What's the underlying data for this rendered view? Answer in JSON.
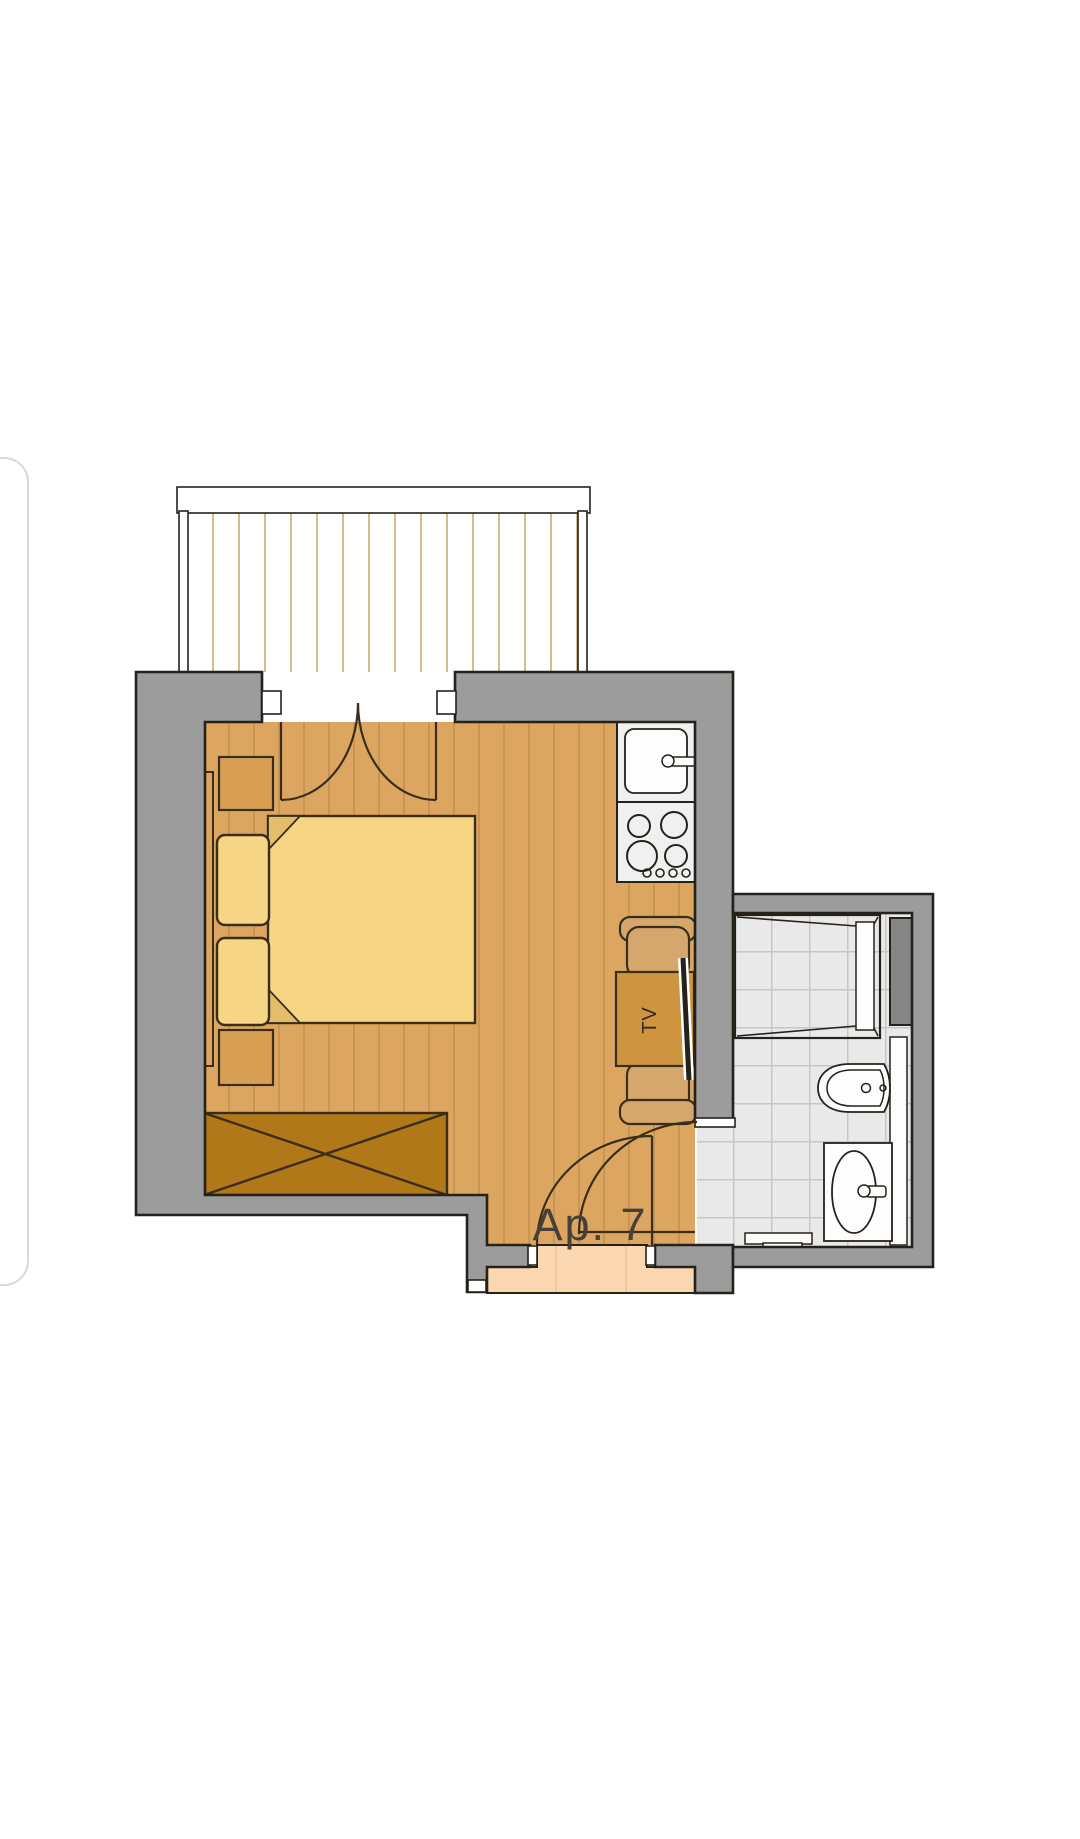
{
  "labels": {
    "apartment": "Ap. 7",
    "tv": "TV"
  },
  "colors": {
    "wall_fill": "#9c9c9c",
    "outline": "#26211a",
    "furn_outline": "#3a2d1b",
    "floor": "#dca661",
    "floor_stripe": "#c3924e",
    "bed": "#f6d584",
    "bed_fold": "#e3bd69",
    "furniture": "#d89f52",
    "wardrobe": "#b07818",
    "table": "#ce9440",
    "chair": "#d5a76c",
    "fixture_bg": "#f0f0f0",
    "fixture_white": "#fdfdfd",
    "tile_bg": "#e9e9e9",
    "tile_line": "#c6c6c6",
    "shaft": "#868686",
    "entry_floor": "#fad7b0",
    "entry_stripe": "#e8c29b",
    "deck_line": "#cdaa6f",
    "label": "#46403a",
    "tv_label": "#33291a",
    "card_edge": "#d8d8d8"
  },
  "rooms_depicted": {
    "balcony": true,
    "main_room": true,
    "kitchenette": true,
    "bathroom": true,
    "entry": true
  },
  "fixtures": {
    "stove_burners": 4,
    "stove_knobs": 4,
    "beds": 1,
    "pillows": 2,
    "nightstands": 2,
    "chairs": 2
  }
}
